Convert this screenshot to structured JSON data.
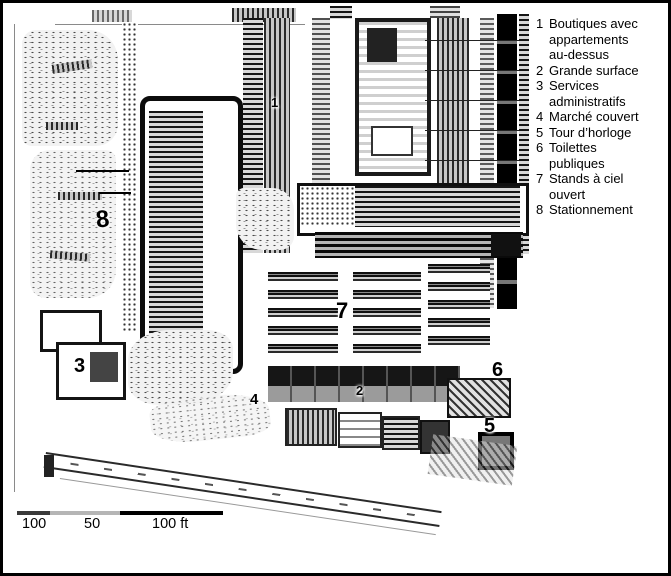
{
  "figure": {
    "type": "architectural-site-plan",
    "background_color": "#ffffff",
    "ink_color": "#000000",
    "frame_color": "#000000"
  },
  "legend": {
    "items": [
      {
        "num": "1",
        "lines": [
          "Boutiques avec",
          "appartements",
          "au-dessus"
        ]
      },
      {
        "num": "2",
        "lines": [
          "Grande surface"
        ]
      },
      {
        "num": "3",
        "lines": [
          "Services",
          "administratifs"
        ]
      },
      {
        "num": "4",
        "lines": [
          "Marché couvert"
        ]
      },
      {
        "num": "5",
        "lines": [
          "Tour d’horloge"
        ]
      },
      {
        "num": "6",
        "lines": [
          "Toilettes",
          "publiques"
        ]
      },
      {
        "num": "7",
        "lines": [
          "Stands à ciel",
          "ouvert"
        ]
      },
      {
        "num": "8",
        "lines": [
          "Stationnement"
        ]
      }
    ]
  },
  "plan": {
    "markers": [
      {
        "label": "1"
      },
      {
        "label": "2"
      },
      {
        "label": "3"
      },
      {
        "label": "4"
      },
      {
        "label": "5"
      },
      {
        "label": "6"
      },
      {
        "label": "7"
      },
      {
        "label": "8"
      }
    ]
  },
  "scale_bar": {
    "labels": [
      "100",
      "50",
      "100 ft"
    ]
  }
}
